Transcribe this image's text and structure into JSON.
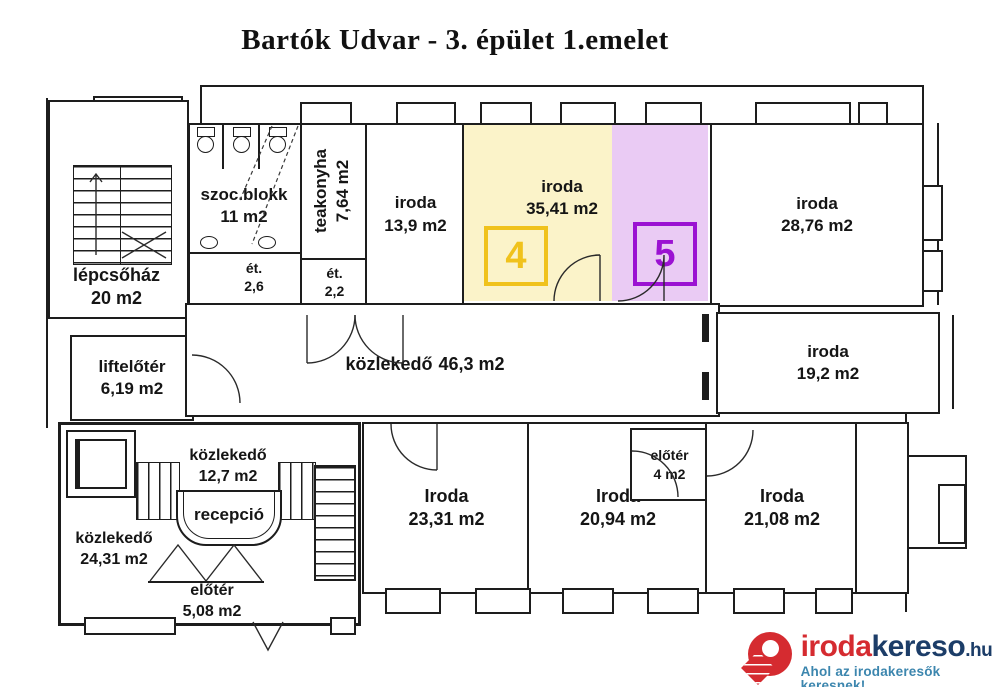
{
  "title": "Bartók Udvar - 3. épület 1.emelet",
  "rooms": {
    "lepcsohaz": {
      "name": "lépcsőház",
      "area": "20 m2"
    },
    "liftelooter": {
      "name": "liftelőtér",
      "area": "6,19 m2"
    },
    "szocblokk": {
      "name": "szoc.blokk",
      "area": "11 m2"
    },
    "etkezo_szoc": {
      "name": "ét.",
      "area": "2,6"
    },
    "teakonyha": {
      "name": "teakonyha",
      "area": "7,64 m2"
    },
    "etkezo_tea": {
      "name": "ét.",
      "area": "2,2"
    },
    "iroda_139": {
      "name": "iroda",
      "area": "13,9 m2"
    },
    "iroda_3541": {
      "name": "iroda",
      "area": "35,41 m2"
    },
    "iroda_2876": {
      "name": "iroda",
      "area": "28,76 m2"
    },
    "kozlekedo_463": {
      "name": "közlekedő",
      "area": "46,3 m2"
    },
    "iroda_192": {
      "name": "iroda",
      "area": "19,2 m2"
    },
    "kozlekedo_127": {
      "name": "közlekedő",
      "area": "12,7 m2"
    },
    "recepcio": {
      "name": "recepció"
    },
    "kozlekedo_2431": {
      "name": "közlekedő",
      "area": "24,31 m2"
    },
    "eloter_508": {
      "name": "előtér",
      "area": "5,08 m2"
    },
    "iroda_2331": {
      "name": "Iroda",
      "area": "23,31 m2"
    },
    "iroda_2094": {
      "name": "Iroda",
      "area": "20,94 m2"
    },
    "eloter_4": {
      "name": "előtér",
      "area": "4 m2"
    },
    "iroda_2108": {
      "name": "Iroda",
      "area": "21,08 m2"
    }
  },
  "units": {
    "unit4": {
      "number": "4",
      "fill": "#FBF3C9",
      "accent": "#F0C21C"
    },
    "unit5": {
      "number": "5",
      "fill": "#EACBF4",
      "accent": "#9B12D2"
    }
  },
  "logo": {
    "brand_primary": "iroda",
    "brand_secondary": "kereso",
    "tld": ".hu",
    "tagline": "Ahol az irodakeresők keresnek!",
    "colors": {
      "red": "#D52B30",
      "navy": "#1C3D68",
      "tagline": "#3C86AE"
    }
  }
}
